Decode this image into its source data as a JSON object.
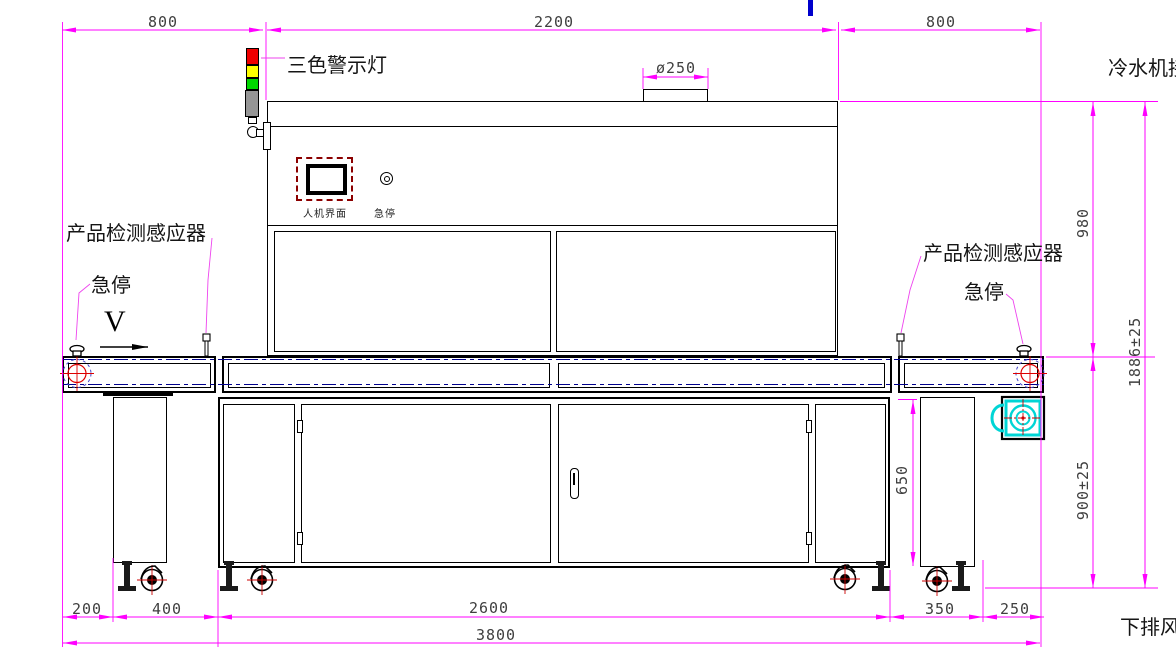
{
  "drawing": {
    "dimensions": {
      "top_left": "800",
      "top_center": "2200",
      "top_right": "800",
      "duct_diameter": "ø250",
      "oven_height": "980",
      "total_height": "1886±25",
      "table_height": "900±25",
      "leg_height": "650",
      "bottom_overhang": "200",
      "bottom_leg": "400",
      "bottom_cabinet": "2600",
      "bottom_right_leg": "350",
      "bottom_right_overhang": "250",
      "bottom_total": "3800"
    },
    "labels": {
      "warning_light": "三色警示灯",
      "product_sensor_left": "产品检测感应器",
      "product_sensor_right": "产品检测感应器",
      "estop_left": "急停",
      "estop_right": "急停",
      "hmi": "人机界面",
      "estop_panel": "急停",
      "chiller": "冷水机接",
      "bottom_exhaust": "下排风",
      "direction": "V"
    },
    "colors": {
      "dimension_magenta": "#FF00FF",
      "centerline_navy": "#00008B",
      "warning_red": "#F00000",
      "warning_yellow": "#FFFF00",
      "warning_green": "#00D800",
      "warning_gray": "#969696",
      "fan_cyan": "#00D5D5",
      "hmi_frame_darkred": "#8B0000",
      "pulley_red": "#DD0000",
      "artifact_blue": "#0000CC"
    }
  }
}
